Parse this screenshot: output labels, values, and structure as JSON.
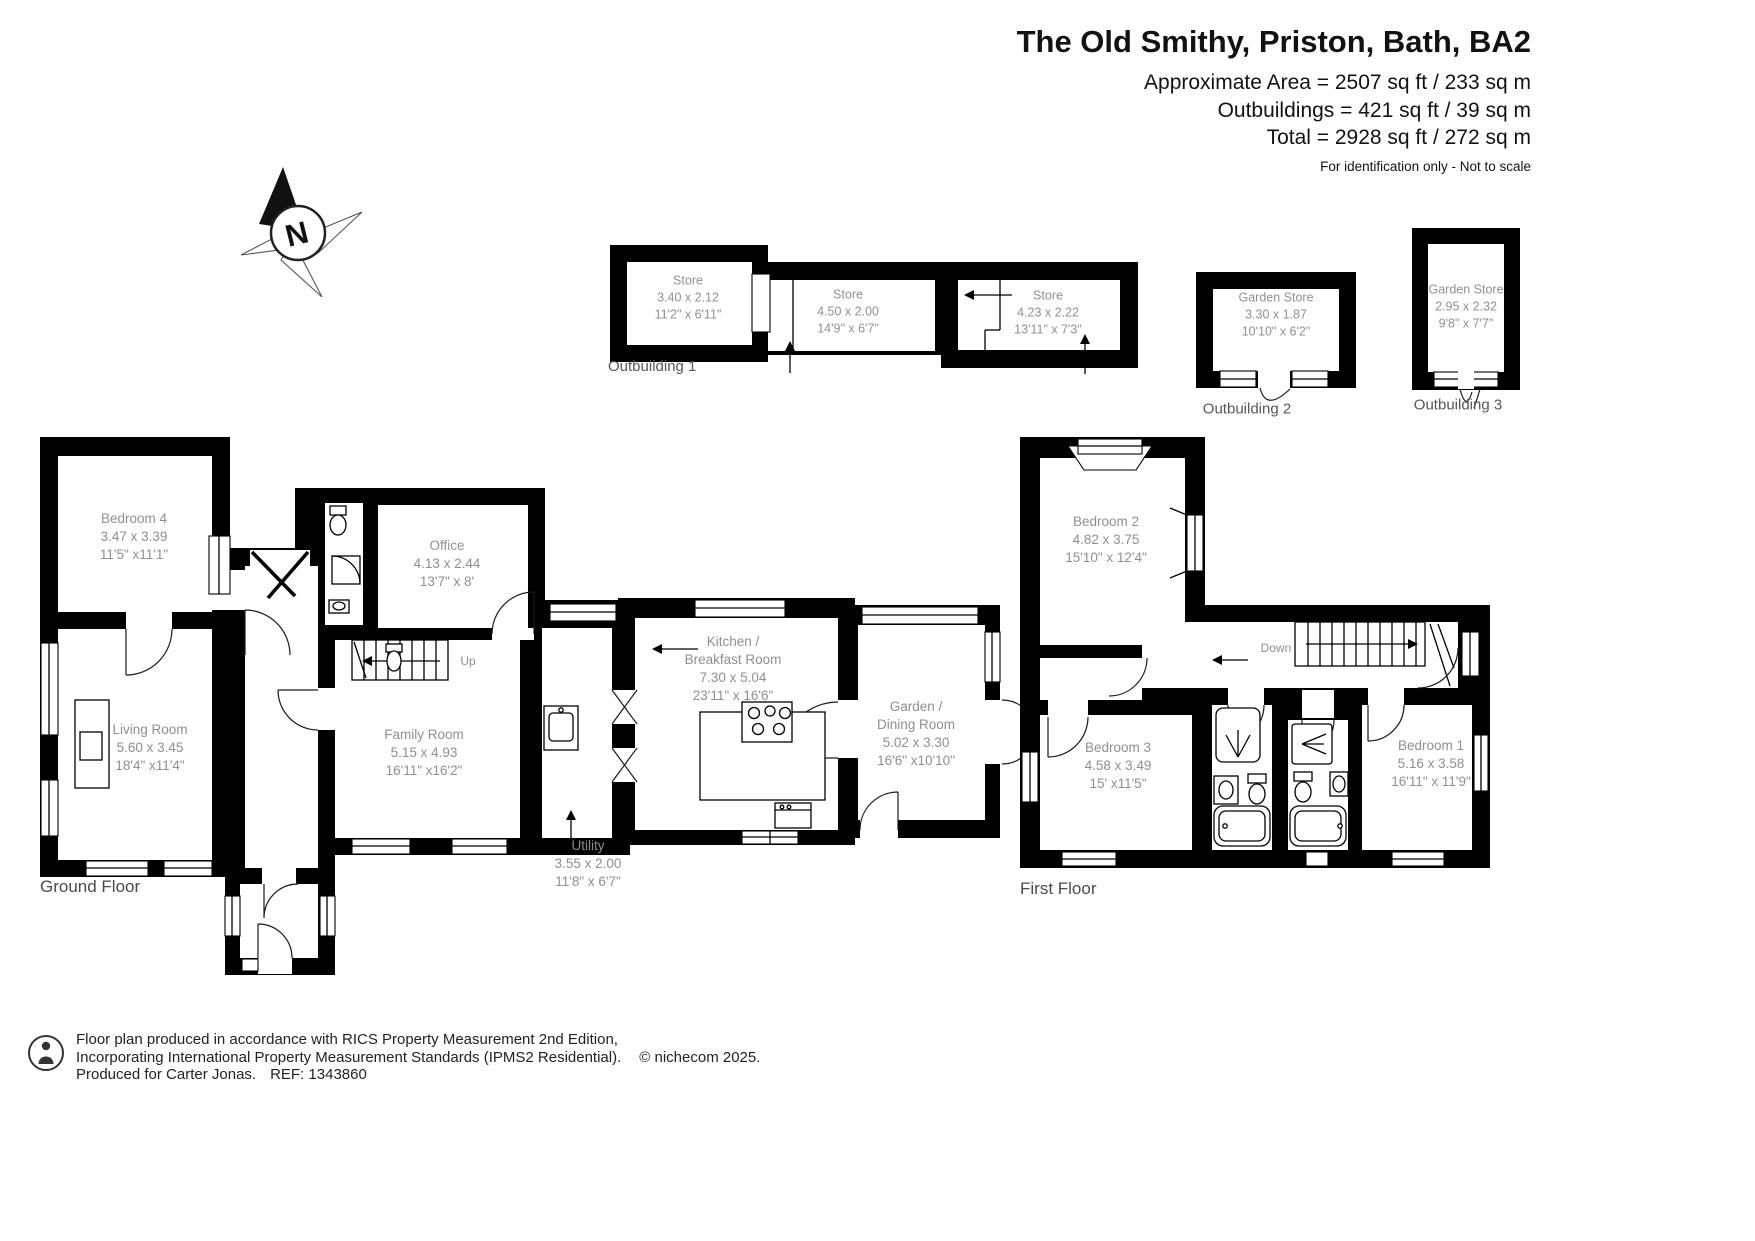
{
  "header": {
    "title": "The Old Smithy, Priston, Bath, BA2",
    "area_lines": [
      "Approximate Area = 2507 sq ft / 233 sq m",
      "Outbuildings = 421 sq ft / 39 sq m",
      "Total = 2928 sq ft / 272 sq m"
    ],
    "disclaimer": "For identification only - Not to scale"
  },
  "compass": {
    "north_label": "N"
  },
  "outbuilding1": {
    "label": "Outbuilding 1",
    "store1": {
      "name": "Store",
      "metric": "3.40 x 2.12",
      "imperial": "11'2\" x 6'11\""
    },
    "store2": {
      "name": "Store",
      "metric": "4.50 x 2.00",
      "imperial": "14'9\" x 6'7\""
    },
    "store3": {
      "name": "Store",
      "metric": "4.23 x 2.22",
      "imperial": "13'11\" x 7'3\""
    }
  },
  "outbuilding2": {
    "label": "Outbuilding 2",
    "store": {
      "name": "Garden Store",
      "metric": "3.30 x 1.87",
      "imperial": "10'10\" x 6'2\""
    }
  },
  "outbuilding3": {
    "label": "Outbuilding 3",
    "store": {
      "name": "Garden Store",
      "metric": "2.95 x 2.32",
      "imperial": "9'8\" x 7'7\""
    }
  },
  "ground_floor": {
    "title": "Ground Floor",
    "stairs_label": "Up",
    "bedroom4": {
      "name": "Bedroom 4",
      "metric": "3.47 x 3.39",
      "imperial": "11'5\" x11'1\""
    },
    "living_room": {
      "name": "Living Room",
      "metric": "5.60 x 3.45",
      "imperial": "18'4\" x11'4\""
    },
    "office": {
      "name": "Office",
      "metric": "4.13 x 2.44",
      "imperial": "13'7\" x 8'"
    },
    "family_room": {
      "name": "Family Room",
      "metric": "5.15 x 4.93",
      "imperial": "16'11\" x16'2\""
    },
    "kitchen": {
      "name_line1": "Kitchen /",
      "name_line2": "Breakfast Room",
      "metric": "7.30 x 5.04",
      "imperial": "23'11\" x 16'6\""
    },
    "garden_dining": {
      "name_line1": "Garden /",
      "name_line2": "Dining Room",
      "metric": "5.02 x 3.30",
      "imperial": "16'6\" x10'10\""
    },
    "utility": {
      "name": "Utility",
      "metric": "3.55 x 2.00",
      "imperial": "11'8\" x 6'7\""
    }
  },
  "first_floor": {
    "title": "First Floor",
    "stairs_label": "Down",
    "bedroom1": {
      "name": "Bedroom 1",
      "metric": "5.16 x 3.58",
      "imperial": "16'11\" x 11'9\""
    },
    "bedroom2": {
      "name": "Bedroom 2",
      "metric": "4.82 x 3.75",
      "imperial": "15'10\" x 12'4\""
    },
    "bedroom3": {
      "name": "Bedroom 3",
      "metric": "4.58 x 3.49",
      "imperial": "15' x11'5\""
    }
  },
  "footer": {
    "line1": "Floor plan produced in accordance with RICS Property Measurement 2nd Edition,",
    "line2": "Incorporating International Property Measurement Standards (IPMS2 Residential).",
    "copyright": "© nichecom 2025.",
    "line3": "Produced for Carter Jonas.",
    "ref": "REF: 1343860"
  }
}
